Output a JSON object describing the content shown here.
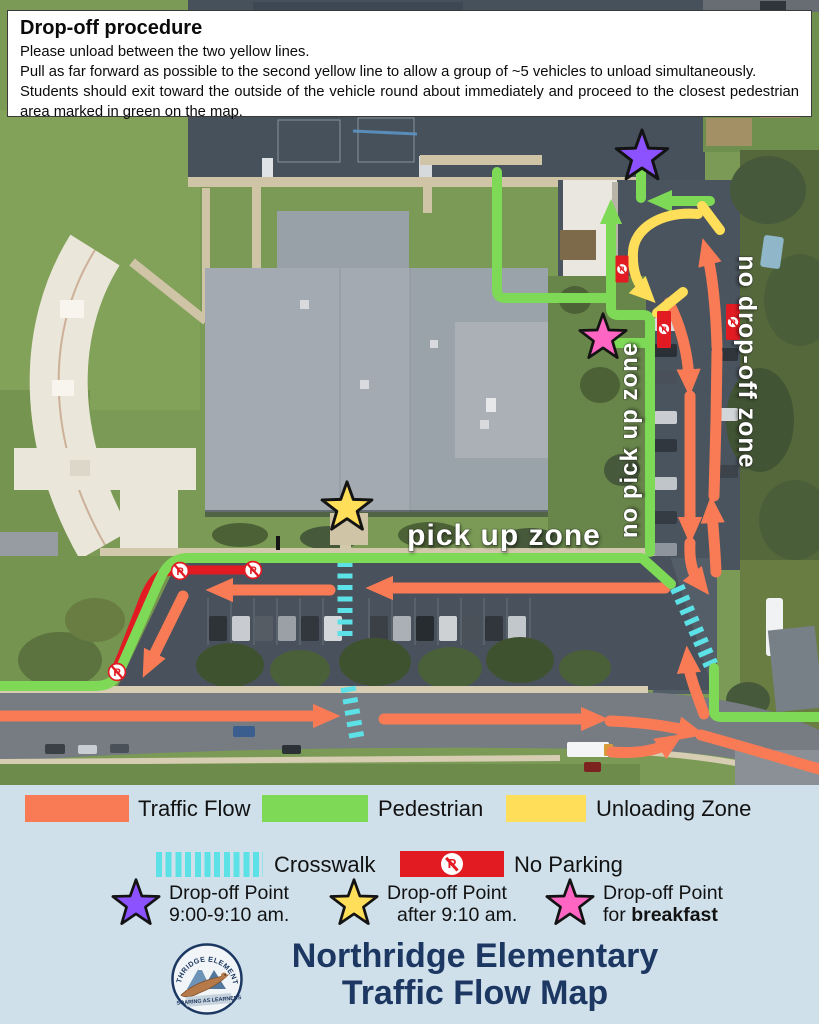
{
  "procedure": {
    "title": "Drop-off procedure",
    "line1": "Please unload between the two yellow lines.",
    "line2": "Pull as far forward as possible to the second yellow line to allow a group of ~5 vehicles to unload simultaneously.",
    "line3": "Students should exit toward the outside of the vehicle round about immediately and proceed to the closest pedestrian area marked in green on the map."
  },
  "map": {
    "labels": {
      "pick_up_zone": "pick up zone",
      "no_pick_up_zone": "no pick up zone",
      "no_drop_off_zone": "no drop-off zone"
    }
  },
  "legend": {
    "traffic_flow": "Traffic Flow",
    "pedestrian": "Pedestrian",
    "unloading_zone": "Unloading Zone",
    "crosswalk": "Crosswalk",
    "no_parking": "No Parking",
    "np_symbol": "P",
    "dropoff_purple": {
      "line1": "Drop-off Point",
      "line2": "9:00-9:10 am."
    },
    "dropoff_yellow": {
      "line1": "Drop-off Point",
      "line2": "after 9:10 am."
    },
    "dropoff_pink": {
      "line1": "Drop-off Point",
      "line2_prefix": "for ",
      "line2_bold": "breakfast"
    }
  },
  "footer": {
    "title_line1": "Northridge Elementary",
    "title_line2": "Traffic Flow Map",
    "logo_arc_text": "NORTHRIDGE ELEMENTARY",
    "logo_banner": "SOARING AS LEARNERS"
  },
  "colors": {
    "traffic": "#f97b56",
    "pedestrian": "#7ed957",
    "unloading": "#ffde59",
    "crosswalk": "#5ce1e6",
    "no_parking_red": "#e21b22",
    "star_purple": "#8c52ff",
    "star_yellow": "#ffde59",
    "star_pink": "#ff66c4",
    "title_navy": "#1c3761",
    "page_bg": "#cfe0eb"
  }
}
